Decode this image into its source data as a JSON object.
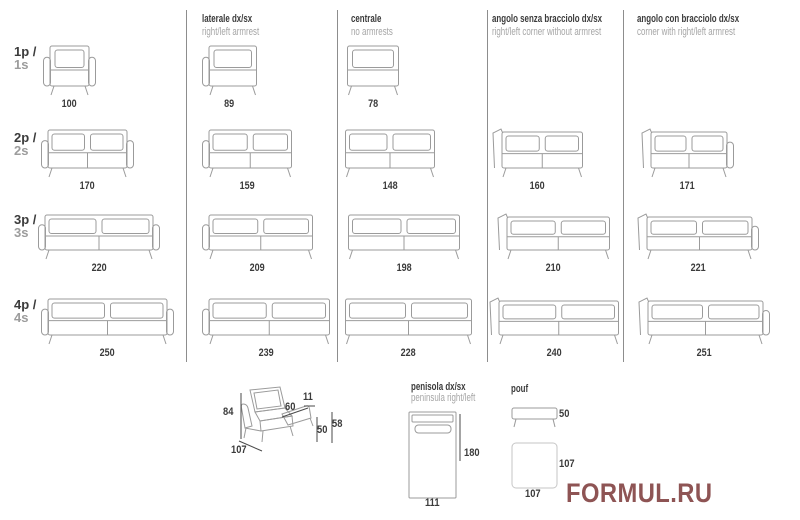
{
  "columns": [
    {
      "title": "",
      "subtitle": ""
    },
    {
      "title": "laterale dx/sx",
      "subtitle": "right/left armrest"
    },
    {
      "title": "centrale",
      "subtitle": "no armrests"
    },
    {
      "title": "angolo senza bracciolo dx/sx",
      "subtitle": "right/left corner without armrest"
    },
    {
      "title": "angolo con bracciolo dx/sx",
      "subtitle": "corner with right/left armrest"
    }
  ],
  "rows": [
    {
      "label_it": "1p /",
      "label_en": "1s"
    },
    {
      "label_it": "2p /",
      "label_en": "2s"
    },
    {
      "label_it": "3p /",
      "label_en": "3s"
    },
    {
      "label_it": "4p /",
      "label_en": "4s"
    }
  ],
  "grid_widths_cm": [
    [
      100,
      89,
      78,
      null,
      null
    ],
    [
      170,
      159,
      148,
      160,
      171
    ],
    [
      220,
      209,
      198,
      210,
      221
    ],
    [
      250,
      239,
      228,
      240,
      251
    ]
  ],
  "side_view_dims": {
    "height": "84",
    "depth": "107",
    "seat_depth": "60",
    "back_cushion_thickness": "11",
    "seat_height": "50",
    "armrest_height": "58"
  },
  "peninsula": {
    "title": "penisola dx/sx",
    "subtitle": "peninsula right/left",
    "length": "180",
    "width": "111"
  },
  "pouf": {
    "title": "pouf",
    "height": "50",
    "depth": "107",
    "width": "107"
  },
  "watermark": "FORMUL.RU",
  "colors": {
    "line": "#9b9b9b",
    "divider": "#8d8d8d",
    "text_dark": "#3b3b3b",
    "text_gray": "#a5a5a5",
    "watermark": "#8e5454",
    "pouf_top_outline": "#c6c6c6"
  }
}
